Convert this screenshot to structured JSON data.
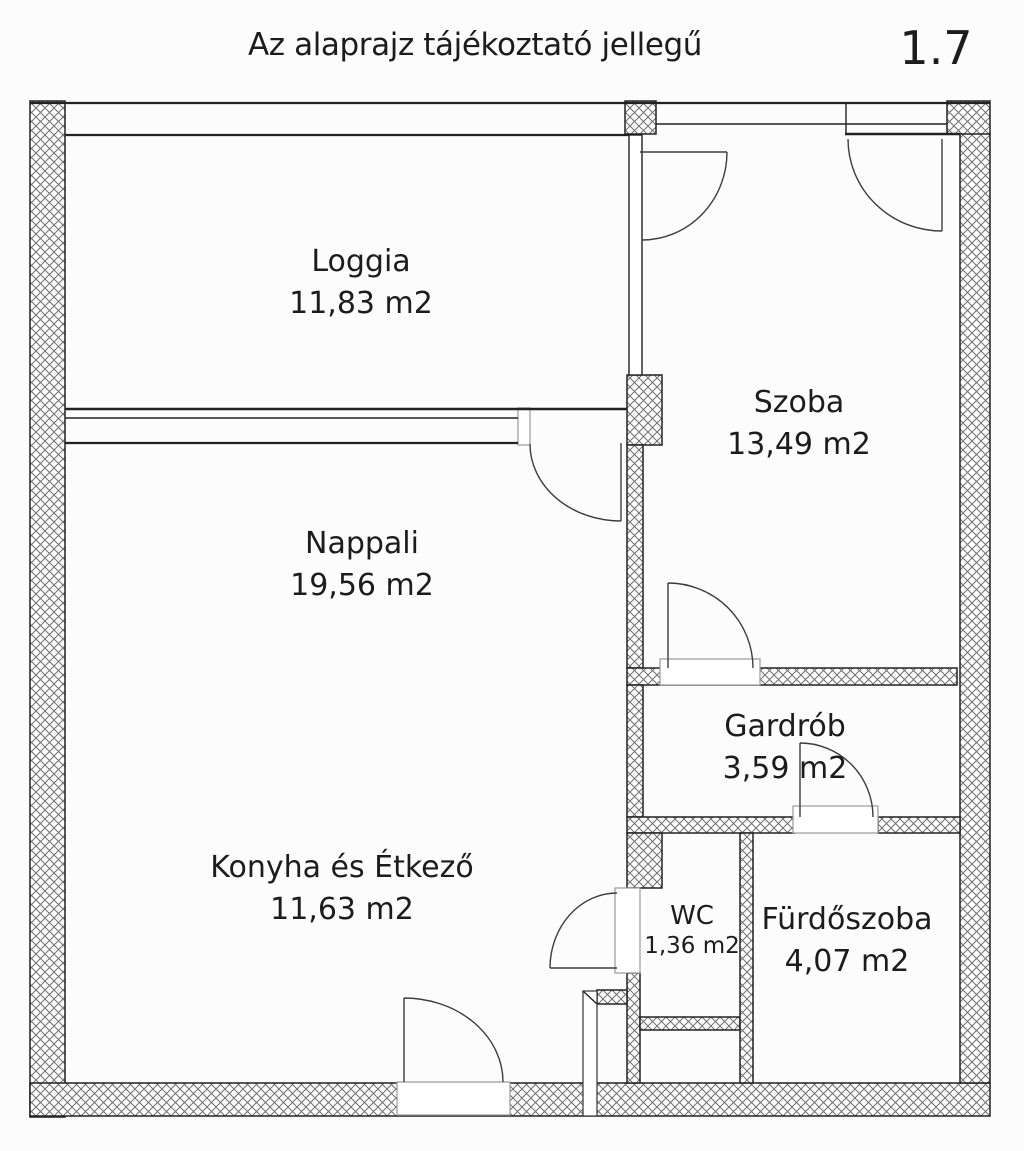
{
  "header": {
    "title": "Az alaprajz tájékoztató jellegű",
    "plan_number": "1.7"
  },
  "rooms": [
    {
      "name": "Loggia",
      "area": "11,83 m2"
    },
    {
      "name": "Szoba",
      "area": "13,49 m2"
    },
    {
      "name": "Nappali",
      "area": "19,56 m2"
    },
    {
      "name": "Gardrób",
      "area": "3,59 m2"
    },
    {
      "name": "Konyha és Étkező",
      "area": "11,63 m2"
    },
    {
      "name": "WC",
      "area": "1,36 m2"
    },
    {
      "name": "Fürdőszoba",
      "area": "4,07 m2"
    }
  ],
  "palette": {
    "line": "#222222",
    "hatch": "#6f6f6f",
    "door": "#3d3d3d",
    "text": "#1c1c1c",
    "background": "#fcfcfc",
    "paper": "#ffffff"
  }
}
